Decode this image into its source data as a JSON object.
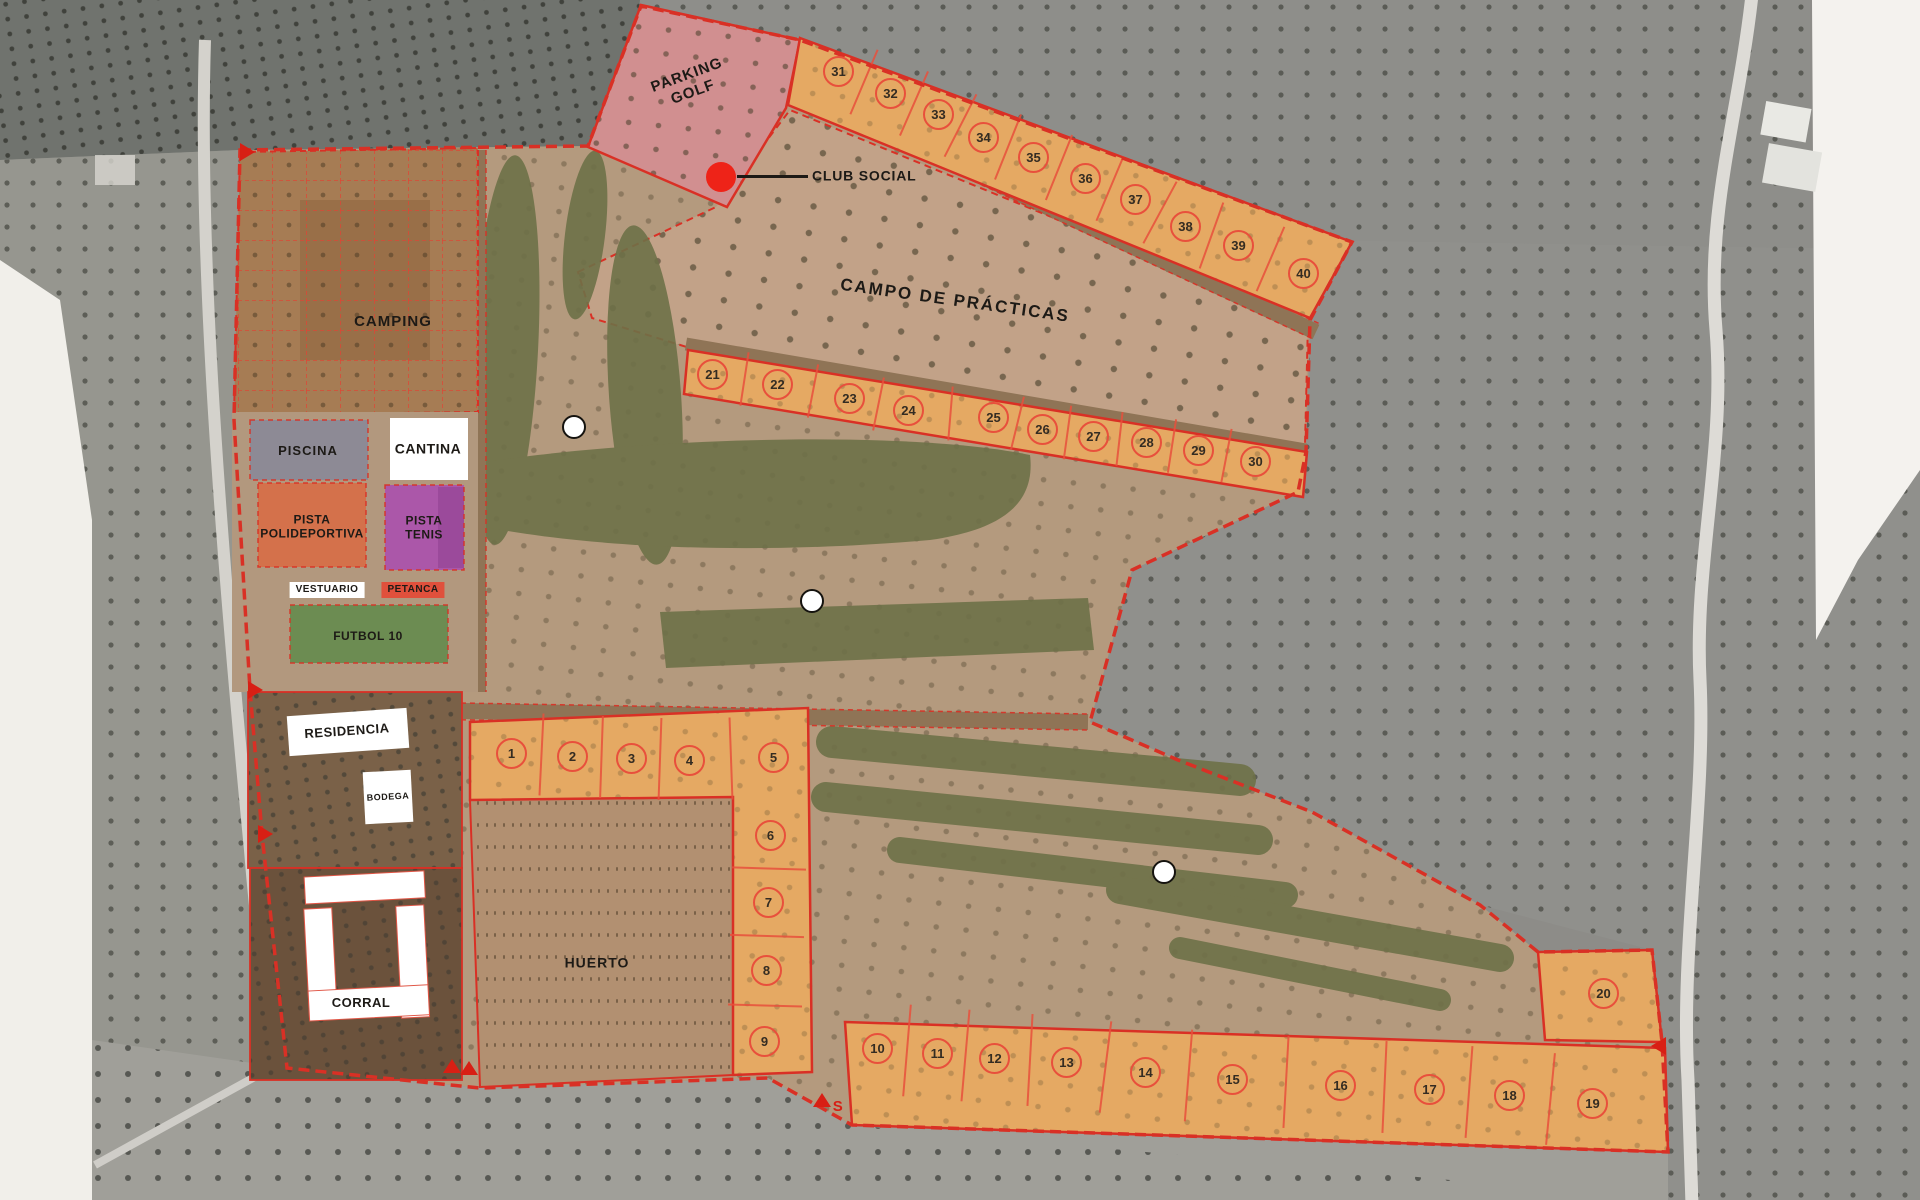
{
  "map": {
    "labels": {
      "camping": "CAMPING",
      "parking_line1": "PARKING",
      "parking_line2": "GOLF",
      "club_social": "CLUB SOCIAL",
      "campo": "CAMPO DE PRÁCTICAS",
      "piscina": "PISCINA",
      "cantina": "CANTINA",
      "polideportiva_line1": "PISTA",
      "polideportiva_line2": "POLIDEPORTIVA",
      "tenis_line1": "PISTA",
      "tenis_line2": "TENIS",
      "vestuario": "VESTUARIO",
      "petanca": "PETANCA",
      "futbol": "FUTBOL 10",
      "residencia": "RESIDENCIA",
      "bodega": "BODEGA",
      "corral": "CORRAL",
      "huerto": "HUERTO",
      "s_marker": "S"
    },
    "plots": [
      {
        "n": "1",
        "x": 511,
        "y": 753
      },
      {
        "n": "2",
        "x": 572,
        "y": 756
      },
      {
        "n": "3",
        "x": 631,
        "y": 758
      },
      {
        "n": "4",
        "x": 689,
        "y": 760
      },
      {
        "n": "5",
        "x": 773,
        "y": 757
      },
      {
        "n": "6",
        "x": 770,
        "y": 835
      },
      {
        "n": "7",
        "x": 768,
        "y": 902
      },
      {
        "n": "8",
        "x": 766,
        "y": 970
      },
      {
        "n": "9",
        "x": 764,
        "y": 1041
      },
      {
        "n": "10",
        "x": 877,
        "y": 1048
      },
      {
        "n": "11",
        "x": 937,
        "y": 1053
      },
      {
        "n": "12",
        "x": 994,
        "y": 1058
      },
      {
        "n": "13",
        "x": 1066,
        "y": 1062
      },
      {
        "n": "14",
        "x": 1145,
        "y": 1072
      },
      {
        "n": "15",
        "x": 1232,
        "y": 1079
      },
      {
        "n": "16",
        "x": 1340,
        "y": 1085
      },
      {
        "n": "17",
        "x": 1429,
        "y": 1089
      },
      {
        "n": "18",
        "x": 1509,
        "y": 1095
      },
      {
        "n": "19",
        "x": 1592,
        "y": 1103
      },
      {
        "n": "20",
        "x": 1603,
        "y": 993
      },
      {
        "n": "21",
        "x": 712,
        "y": 374
      },
      {
        "n": "22",
        "x": 777,
        "y": 384
      },
      {
        "n": "23",
        "x": 849,
        "y": 398
      },
      {
        "n": "24",
        "x": 908,
        "y": 410
      },
      {
        "n": "25",
        "x": 993,
        "y": 417
      },
      {
        "n": "26",
        "x": 1042,
        "y": 429
      },
      {
        "n": "27",
        "x": 1093,
        "y": 436
      },
      {
        "n": "28",
        "x": 1146,
        "y": 442
      },
      {
        "n": "29",
        "x": 1198,
        "y": 450
      },
      {
        "n": "30",
        "x": 1255,
        "y": 461
      },
      {
        "n": "31",
        "x": 838,
        "y": 71
      },
      {
        "n": "32",
        "x": 890,
        "y": 93
      },
      {
        "n": "33",
        "x": 938,
        "y": 114
      },
      {
        "n": "34",
        "x": 983,
        "y": 137
      },
      {
        "n": "35",
        "x": 1033,
        "y": 157
      },
      {
        "n": "36",
        "x": 1085,
        "y": 178
      },
      {
        "n": "37",
        "x": 1135,
        "y": 199
      },
      {
        "n": "38",
        "x": 1185,
        "y": 226
      },
      {
        "n": "39",
        "x": 1238,
        "y": 245
      },
      {
        "n": "40",
        "x": 1303,
        "y": 273
      }
    ],
    "strips": [
      {
        "half": 35,
        "ids": [
          31,
          32,
          33,
          34,
          35,
          36,
          37,
          38,
          39,
          40
        ]
      },
      {
        "half": 27,
        "ids": [
          21,
          22,
          23,
          24,
          25,
          26,
          27,
          28,
          29,
          30
        ]
      },
      {
        "half": 41,
        "ids": [
          1,
          2,
          3,
          4,
          5
        ]
      },
      {
        "half": 37,
        "ids": [
          6,
          7,
          8,
          9
        ]
      },
      {
        "half": 46,
        "ids": [
          10,
          11,
          12,
          13,
          14,
          15,
          16,
          17,
          18,
          19
        ]
      }
    ],
    "greens": [
      {
        "x": 574,
        "y": 427
      },
      {
        "x": 812,
        "y": 601
      },
      {
        "x": 1164,
        "y": 872
      }
    ],
    "triangles": [
      {
        "d": "right",
        "x": 244,
        "y": 152
      },
      {
        "d": "right",
        "x": 252,
        "y": 690
      },
      {
        "d": "right",
        "x": 262,
        "y": 834
      },
      {
        "d": "up",
        "x": 452,
        "y": 1072
      },
      {
        "d": "up",
        "x": 469,
        "y": 1074
      },
      {
        "d": "up",
        "x": 822,
        "y": 1106
      },
      {
        "d": "left",
        "x": 1662,
        "y": 1046
      }
    ],
    "colors": {
      "boundary": "#d93025",
      "plotline": "#e8503c",
      "plotfill": "#e5a963",
      "parking": "#d18f90",
      "piscina": "#8d8a95",
      "poli": "#d4714b",
      "tenis": "#ab57a9",
      "futbol": "#6c8c52",
      "petanca": "#e0503c",
      "fairway": "#6e7148",
      "campo": "#c2a288",
      "camping": "#a67c54",
      "huerto": "#b29071",
      "ground": "#b49a7e",
      "clubdot": "#ee2318"
    }
  }
}
